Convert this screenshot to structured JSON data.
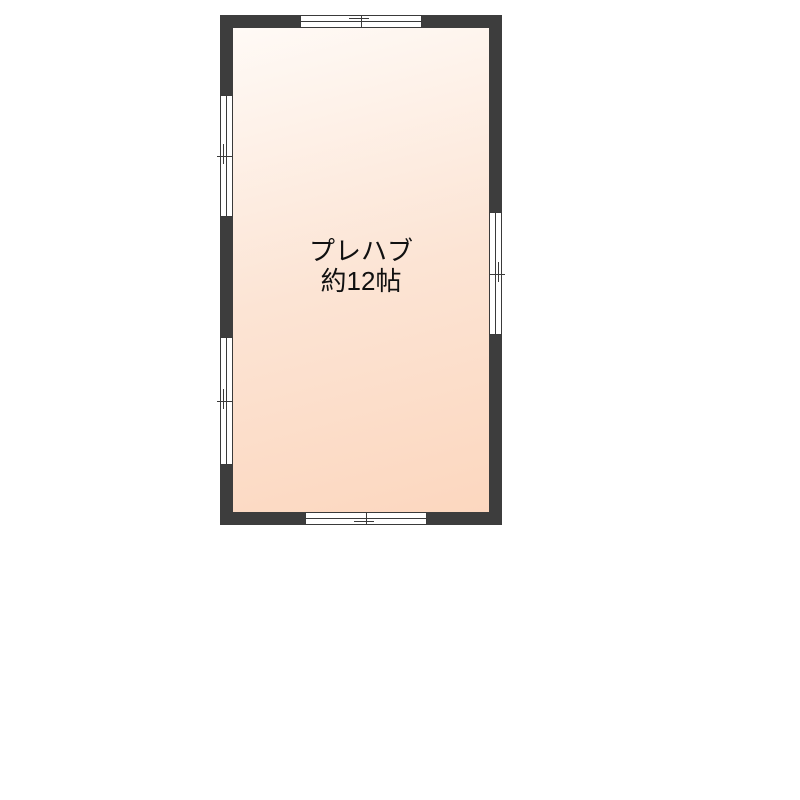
{
  "floorplan": {
    "room": {
      "name": "プレハブ",
      "size": "約12帖"
    },
    "windows": [
      {
        "id": "window-top",
        "side": "top",
        "type": "sliding-window"
      },
      {
        "id": "window-left-upper",
        "side": "left",
        "type": "sliding-window"
      },
      {
        "id": "window-left-lower",
        "side": "left",
        "type": "sliding-window"
      },
      {
        "id": "window-right",
        "side": "right",
        "type": "sliding-window"
      },
      {
        "id": "window-bottom",
        "side": "bottom",
        "type": "sliding-window"
      }
    ],
    "colors": {
      "page_bg": "#ffffff",
      "wall": "#3d3d3d",
      "line": "#3a3a3a",
      "floor_light": "#fffaf6",
      "floor_mid": "#fce4d4",
      "floor_dark": "#fcd7bf",
      "text": "#111111"
    }
  }
}
